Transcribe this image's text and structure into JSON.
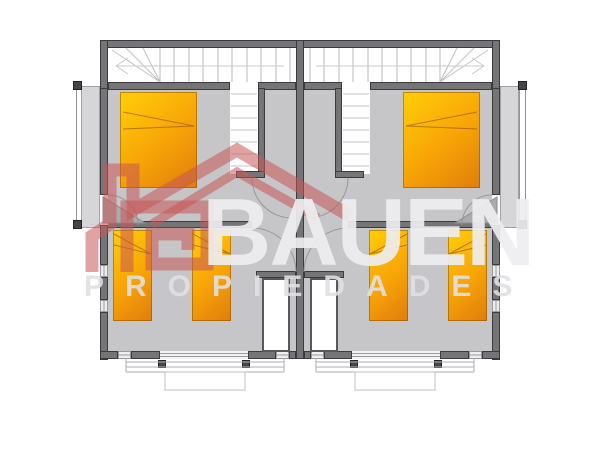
{
  "watermark": {
    "brand": "BAUEN",
    "subtitle": "PROPIEDADES",
    "logo_color": "rgba(199,86,86,0.55)",
    "text_color": "#eeeef0"
  },
  "palette": {
    "background": "#ffffff",
    "floor": "#c6c6c8",
    "wall": "#757578",
    "stair_area": "#ffffff",
    "balcony_floor": "#d6d6d8",
    "bed_gradient_start": "#ffc808",
    "bed_gradient_end": "#e07d0c"
  },
  "plan_contents": {
    "type": "mirrored duplex floor plan",
    "stairwells": 2,
    "double_beds": 2,
    "single_beds": 4,
    "closets": 2,
    "balconies": 2,
    "porches": 2
  }
}
